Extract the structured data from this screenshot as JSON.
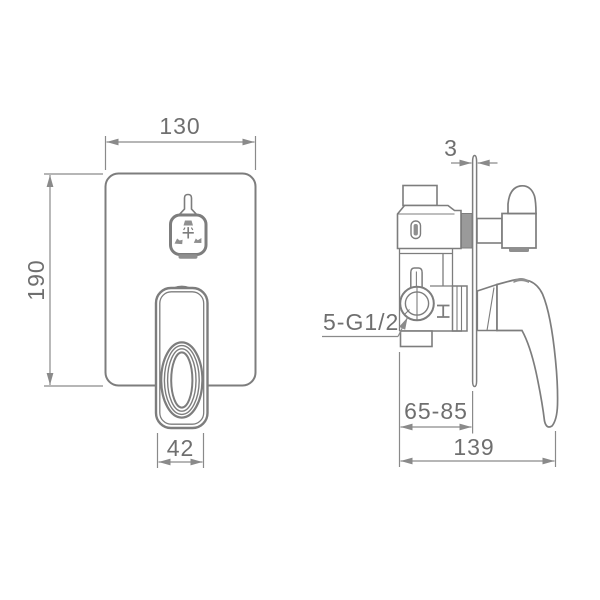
{
  "drawing": {
    "type": "technical-dimension-drawing",
    "subject": "concealed-shower-mixer-valve",
    "colors": {
      "line": "#7d7d7d",
      "dimension_line": "#8a8a8a",
      "text": "#6f6f6f",
      "background": "#ffffff",
      "dark_fill": "#8f8f8f"
    }
  },
  "front_view": {
    "width_dim": "130",
    "height_dim": "190",
    "handle_width_dim": "42",
    "diverter_plus_glyph": "+"
  },
  "side_view": {
    "plate_thickness_dim": "3",
    "inlet_thread_label": "5-G1/2",
    "mounting_depth_dim": "65-85",
    "overall_depth_dim": "139"
  }
}
